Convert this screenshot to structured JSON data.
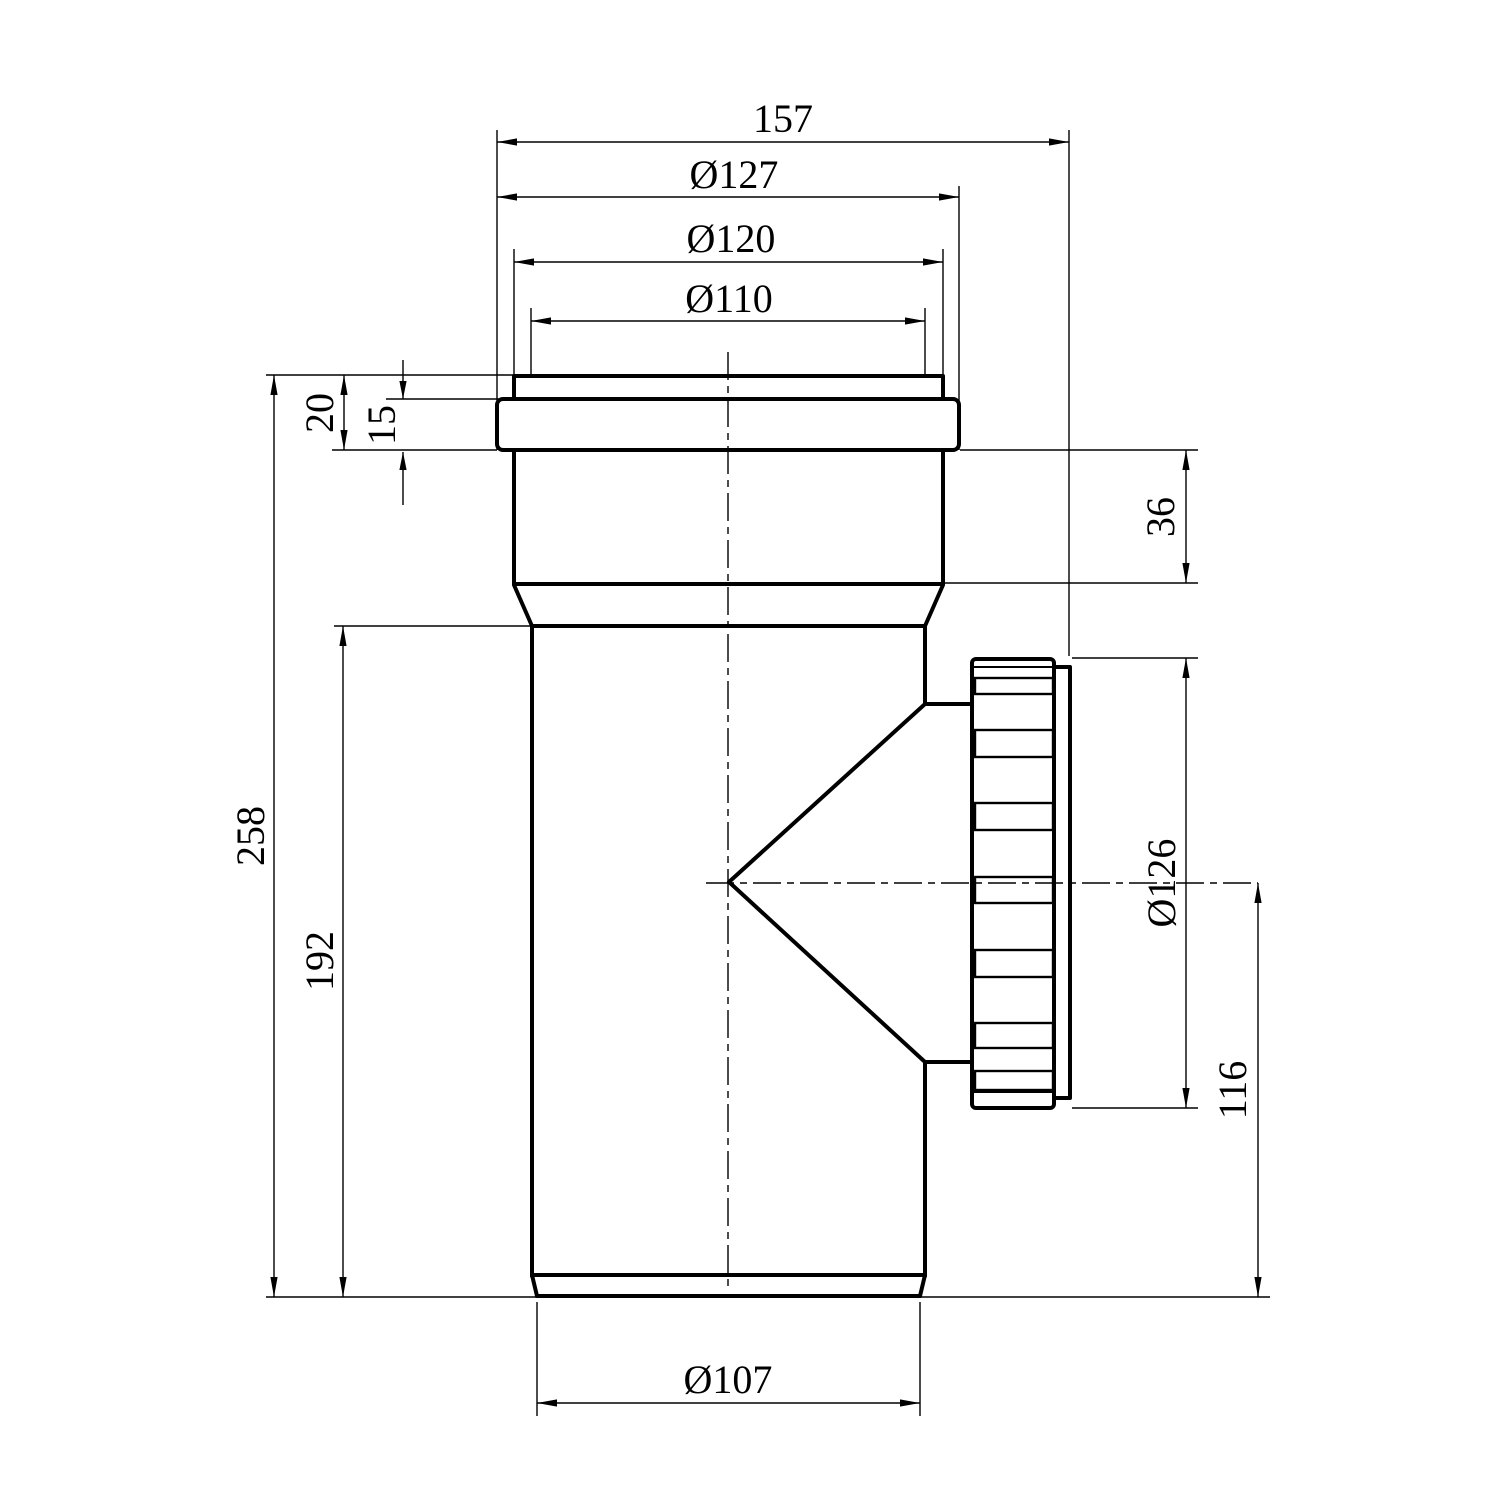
{
  "colors": {
    "line": "#000000",
    "background": "#ffffff"
  },
  "drawing_type": "technical-dimension-drawing",
  "part": "pipe-tee-with-threaded-access-cap",
  "dimensions": {
    "overall_width": {
      "label": "157",
      "mm": 157
    },
    "collar_diameter": {
      "label": "Ø127",
      "mm": 127
    },
    "socket_outer_diameter": {
      "label": "Ø120",
      "mm": 120
    },
    "socket_bore_diameter": {
      "label": "Ø110",
      "mm": 110
    },
    "socket_lip_height": {
      "label": "20",
      "mm": 20
    },
    "collar_height": {
      "label": "15",
      "mm": 15
    },
    "socket_below_collar": {
      "label": "36",
      "mm": 36
    },
    "overall_height": {
      "label": "258",
      "mm": 258
    },
    "body_height": {
      "label": "192",
      "mm": 192
    },
    "cap_diameter": {
      "label": "Ø126",
      "mm": 126
    },
    "branch_axis_to_bottom": {
      "label": "116",
      "mm": 116
    },
    "spigot_diameter": {
      "label": "Ø107",
      "mm": 107
    }
  }
}
